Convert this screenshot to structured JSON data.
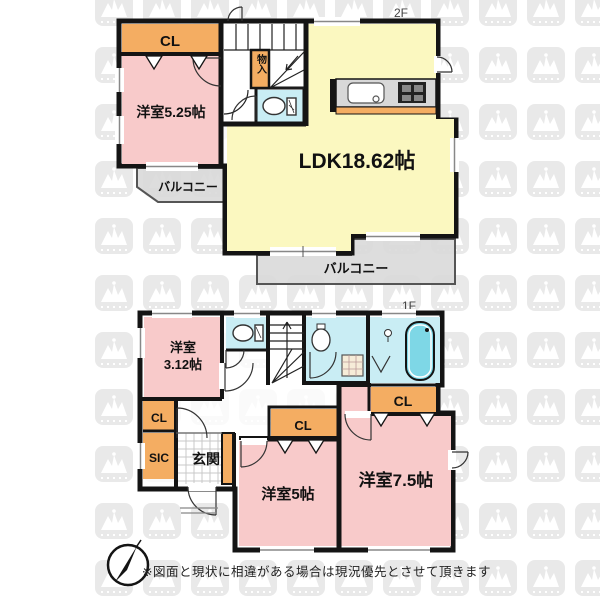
{
  "floor2": {
    "floor_label": "2F",
    "rooms": {
      "closet": "CL",
      "bedroom525": "洋室5.25帖",
      "storage": "物入",
      "ldk": "LDK18.62帖"
    },
    "balcony_left": "バルコニー",
    "balcony_bottom": "バルコニー"
  },
  "floor1": {
    "floor_label": "1F",
    "rooms": {
      "bedroom312_line1": "洋室",
      "bedroom312_line2": "3.12帖",
      "closet_hall": "CL",
      "shoe_closet": "SIC",
      "entrance": "玄関",
      "closet_bedroom5": "CL",
      "closet_bedroom75": "CL",
      "bedroom5": "洋室5帖",
      "bedroom75": "洋室7.5帖"
    }
  },
  "footer": {
    "disclaimer": "※図面と現状に相違がある場合は現況優先とさせて頂きます"
  },
  "colors": {
    "room_pink": "#f8caca",
    "room_yellow": "#fbf8c0",
    "closet_orange": "#f4ad62",
    "wet_area_cyan": "#c9edf4",
    "bathtub_cyan": "#7ed7e6",
    "balcony_gray": "#d9d9d9",
    "wall_black": "#141414",
    "watermark_gray": "#e9e9e9"
  }
}
